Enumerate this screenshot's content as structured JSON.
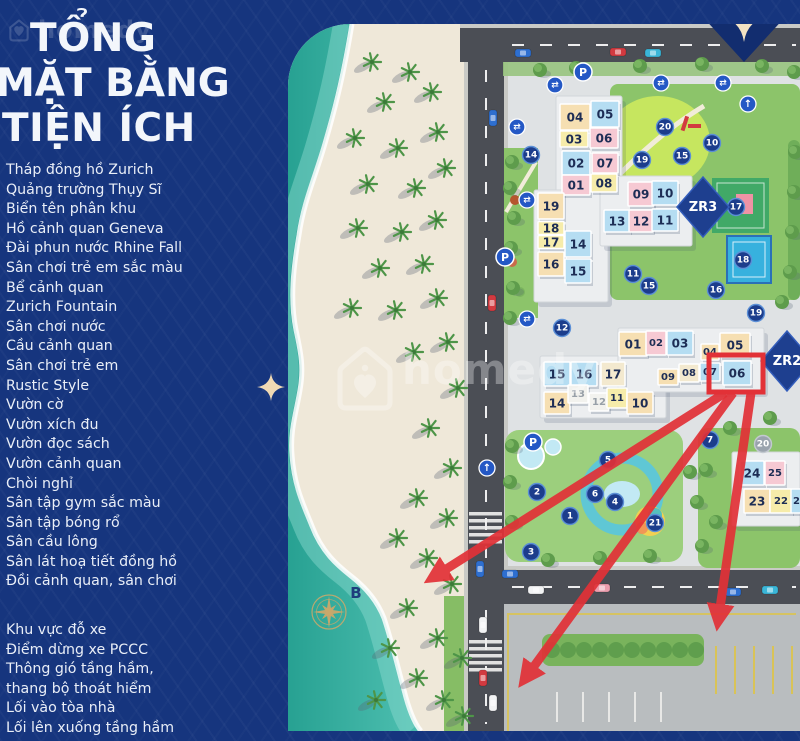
{
  "watermark": {
    "brand": "homedy"
  },
  "panel": {
    "title_lines": [
      "TỔNG",
      "MẶT BẰNG",
      "TIỆN ÍCH"
    ],
    "legend_main": [
      "Tháp đồng hồ Zurich",
      "Quảng trường Thụy Sĩ",
      "Biển tên phân khu",
      "Hồ cảnh quan Geneva",
      "Đài phun nước Rhine Fall",
      "Sân chơi trẻ em sắc màu",
      "Bể cảnh quan",
      "Zurich Fountain",
      "Sân chơi nước",
      "Cầu cảnh quan",
      "Sân chơi trẻ em",
      "Rustic Style",
      "Vườn cờ",
      "Vườn xích đu",
      "Vườn đọc sách",
      "Vườn cảnh quan",
      "Chòi nghỉ",
      "Sân tập gym sắc màu",
      "Sân tập bóng rổ",
      "Sân cầu lông",
      "Sân lát hoạ tiết đồng hồ",
      "Đồi cảnh quan, sân chơi"
    ],
    "legend_secondary": [
      "Khu vực đỗ xe",
      "Điểm dừng xe PCCC",
      "Thông gió tầng hầm,\nthang bộ thoát hiểm",
      "Lối vào tòa nhà",
      "Lối lên xuống tầng hầm"
    ]
  },
  "map": {
    "compass": {
      "label": "B",
      "x": 329,
      "y": 612
    },
    "zones": [
      {
        "label": "ZR3",
        "x": 703,
        "y": 207
      },
      {
        "label": "ZR2",
        "x": 787,
        "y": 361
      }
    ],
    "buildings": [
      {
        "n": "04",
        "x": 575,
        "y": 117,
        "w": 30,
        "h": 26,
        "c": "tan"
      },
      {
        "n": "05",
        "x": 605,
        "y": 114,
        "w": 28,
        "h": 26,
        "c": "blue"
      },
      {
        "n": "03",
        "x": 574,
        "y": 139,
        "w": 28,
        "h": 16,
        "c": "yellow"
      },
      {
        "n": "06",
        "x": 604,
        "y": 138,
        "w": 28,
        "h": 20,
        "c": "pink"
      },
      {
        "n": "02",
        "x": 576,
        "y": 163,
        "w": 28,
        "h": 24,
        "c": "blue"
      },
      {
        "n": "07",
        "x": 605,
        "y": 163,
        "w": 26,
        "h": 20,
        "c": "pink"
      },
      {
        "n": "01",
        "x": 576,
        "y": 185,
        "w": 28,
        "h": 20,
        "c": "pink"
      },
      {
        "n": "08",
        "x": 604,
        "y": 183,
        "w": 26,
        "h": 18,
        "c": "yellow"
      },
      {
        "n": "19",
        "x": 551,
        "y": 206,
        "w": 26,
        "h": 26,
        "c": "tan"
      },
      {
        "n": "18",
        "x": 551,
        "y": 228,
        "w": 26,
        "h": 13,
        "c": "yellow"
      },
      {
        "n": "17",
        "x": 551,
        "y": 242,
        "w": 26,
        "h": 13,
        "c": "yellow"
      },
      {
        "n": "16",
        "x": 551,
        "y": 264,
        "w": 26,
        "h": 24,
        "c": "tan"
      },
      {
        "n": "14",
        "x": 578,
        "y": 244,
        "w": 26,
        "h": 26,
        "c": "blue"
      },
      {
        "n": "15",
        "x": 578,
        "y": 271,
        "w": 26,
        "h": 24,
        "c": "blue"
      },
      {
        "n": "09",
        "x": 641,
        "y": 194,
        "w": 26,
        "h": 24,
        "c": "pink"
      },
      {
        "n": "10",
        "x": 665,
        "y": 193,
        "w": 26,
        "h": 24,
        "c": "blue"
      },
      {
        "n": "13",
        "x": 617,
        "y": 221,
        "w": 26,
        "h": 22,
        "c": "blue"
      },
      {
        "n": "12",
        "x": 641,
        "y": 221,
        "w": 24,
        "h": 22,
        "c": "pink"
      },
      {
        "n": "11",
        "x": 665,
        "y": 220,
        "w": 26,
        "h": 22,
        "c": "blue"
      },
      {
        "n": "01",
        "x": 633,
        "y": 344,
        "w": 28,
        "h": 24,
        "c": "tan"
      },
      {
        "n": "02",
        "x": 656,
        "y": 343,
        "w": 20,
        "h": 24,
        "c": "pink"
      },
      {
        "n": "03",
        "x": 680,
        "y": 343,
        "w": 26,
        "h": 24,
        "c": "blue"
      },
      {
        "n": "04",
        "x": 710,
        "y": 352,
        "w": 18,
        "h": 16,
        "c": "tan"
      },
      {
        "n": "05",
        "x": 735,
        "y": 345,
        "w": 30,
        "h": 24,
        "c": "tan"
      },
      {
        "n": "09",
        "x": 668,
        "y": 377,
        "w": 20,
        "h": 16,
        "c": "tan"
      },
      {
        "n": "08",
        "x": 689,
        "y": 373,
        "w": 20,
        "h": 18,
        "c": "cream"
      },
      {
        "n": "07",
        "x": 710,
        "y": 372,
        "w": 20,
        "h": 18,
        "c": "blue"
      },
      {
        "n": "06",
        "x": 737,
        "y": 373,
        "w": 28,
        "h": 24,
        "c": "blue"
      },
      {
        "n": "15",
        "x": 557,
        "y": 374,
        "w": 26,
        "h": 24,
        "c": "blue"
      },
      {
        "n": "16",
        "x": 584,
        "y": 374,
        "w": 26,
        "h": 24,
        "c": "blue"
      },
      {
        "n": "17",
        "x": 613,
        "y": 374,
        "w": 24,
        "h": 24,
        "c": "cream"
      },
      {
        "n": "14",
        "x": 557,
        "y": 403,
        "w": 26,
        "h": 22,
        "c": "tan"
      },
      {
        "n": "13",
        "x": 578,
        "y": 394,
        "w": 20,
        "h": 18,
        "c": "white",
        "muted": true
      },
      {
        "n": "12",
        "x": 599,
        "y": 402,
        "w": 20,
        "h": 18,
        "c": "white",
        "muted": true
      },
      {
        "n": "11",
        "x": 617,
        "y": 398,
        "w": 20,
        "h": 20,
        "c": "yellow"
      },
      {
        "n": "10",
        "x": 640,
        "y": 403,
        "w": 26,
        "h": 22,
        "c": "tan"
      },
      {
        "n": "24",
        "x": 752,
        "y": 473,
        "w": 24,
        "h": 24,
        "c": "blue"
      },
      {
        "n": "25",
        "x": 775,
        "y": 473,
        "w": 20,
        "h": 24,
        "c": "pink"
      },
      {
        "n": "23",
        "x": 757,
        "y": 501,
        "w": 26,
        "h": 24,
        "c": "tan"
      },
      {
        "n": "22",
        "x": 781,
        "y": 501,
        "w": 22,
        "h": 24,
        "c": "yellow"
      },
      {
        "n": "21",
        "x": 800,
        "y": 501,
        "w": 18,
        "h": 24,
        "c": "blue"
      }
    ],
    "badges": [
      {
        "n": "14",
        "x": 531,
        "y": 155
      },
      {
        "n": "20",
        "x": 665,
        "y": 127
      },
      {
        "n": "10",
        "x": 712,
        "y": 143
      },
      {
        "n": "15",
        "x": 682,
        "y": 156
      },
      {
        "n": "19",
        "x": 642,
        "y": 160
      },
      {
        "n": "17",
        "x": 736,
        "y": 207
      },
      {
        "n": "18",
        "x": 743,
        "y": 260
      },
      {
        "n": "11",
        "x": 633,
        "y": 274
      },
      {
        "n": "15",
        "x": 649,
        "y": 286
      },
      {
        "n": "16",
        "x": 716,
        "y": 290
      },
      {
        "n": "19",
        "x": 756,
        "y": 313
      },
      {
        "n": "12",
        "x": 562,
        "y": 328
      },
      {
        "n": "7",
        "x": 710,
        "y": 440
      },
      {
        "n": "5",
        "x": 608,
        "y": 460
      },
      {
        "n": "2",
        "x": 537,
        "y": 492
      },
      {
        "n": "6",
        "x": 595,
        "y": 494
      },
      {
        "n": "4",
        "x": 615,
        "y": 502
      },
      {
        "n": "1",
        "x": 570,
        "y": 516
      },
      {
        "n": "21",
        "x": 655,
        "y": 523
      },
      {
        "n": "3",
        "x": 531,
        "y": 552
      },
      {
        "n": "20",
        "x": 763,
        "y": 444,
        "grey": true
      }
    ],
    "p_markers": [
      {
        "x": 583,
        "y": 72
      },
      {
        "x": 505,
        "y": 257
      },
      {
        "x": 533,
        "y": 442
      }
    ],
    "swap_markers": [
      {
        "x": 555,
        "y": 85
      },
      {
        "x": 661,
        "y": 83
      },
      {
        "x": 723,
        "y": 83
      },
      {
        "x": 517,
        "y": 127
      },
      {
        "x": 527,
        "y": 200
      },
      {
        "x": 527,
        "y": 319
      }
    ],
    "arrow_markers": [
      {
        "x": 487,
        "y": 468
      },
      {
        "x": 748,
        "y": 104
      }
    ],
    "cars": [
      {
        "x": 523,
        "y": 53,
        "c": "blue",
        "o": "h"
      },
      {
        "x": 618,
        "y": 52,
        "c": "red",
        "o": "h"
      },
      {
        "x": 653,
        "y": 53,
        "c": "teal",
        "o": "h"
      },
      {
        "x": 493,
        "y": 118,
        "c": "blue",
        "o": "v"
      },
      {
        "x": 492,
        "y": 303,
        "c": "red",
        "o": "v"
      },
      {
        "x": 480,
        "y": 569,
        "c": "blue",
        "o": "v"
      },
      {
        "x": 483,
        "y": 625,
        "c": "white",
        "o": "v"
      },
      {
        "x": 483,
        "y": 678,
        "c": "red",
        "o": "v"
      },
      {
        "x": 493,
        "y": 703,
        "c": "white",
        "o": "v"
      },
      {
        "x": 510,
        "y": 574,
        "c": "blue",
        "o": "h"
      },
      {
        "x": 536,
        "y": 590,
        "c": "white",
        "o": "h"
      },
      {
        "x": 602,
        "y": 588,
        "c": "pink",
        "o": "h"
      },
      {
        "x": 733,
        "y": 592,
        "c": "blue",
        "o": "h"
      },
      {
        "x": 770,
        "y": 590,
        "c": "teal",
        "o": "h"
      }
    ],
    "highlight": {
      "box": {
        "x": 709,
        "y": 355,
        "w": 54,
        "h": 37
      },
      "arrows": [
        {
          "x1": 725,
          "y1": 393,
          "x2": 432,
          "y2": 578
        },
        {
          "x1": 733,
          "y1": 393,
          "x2": 524,
          "y2": 680
        },
        {
          "x1": 751,
          "y1": 393,
          "x2": 718,
          "y2": 622
        }
      ]
    }
  },
  "colors": {
    "panel": "#16357e",
    "band": "#122d6f",
    "sea": "#2fae9f",
    "sea_light": "#56c4b4",
    "sand": "#efe8d9",
    "zone_grey": "#dfe2e4",
    "road": "#4b4e55",
    "lawn": "#8cc46a",
    "bright_lawn": "#c6e65f",
    "court_green": "#41a967",
    "court_blue": "#37b1de",
    "court_pink": "#ef93a5",
    "unit_tan": "#f6dfb2",
    "unit_blue": "#b5ddf2",
    "unit_pink": "#f6c9d3",
    "unit_yellow": "#f6ecaa",
    "unit_cream": "#f3e9cf",
    "unit_white": "#f2f2ee",
    "badge": "#1c3d8c",
    "badge_ring": "#5b8fd6",
    "badge_grey": "#9aa3ad",
    "marker_blue": "#2458c5",
    "zone_diamond": "#1e3f8f",
    "red": "#e23137",
    "gold": "#c9a86b",
    "car_blue": "#2e6fd0",
    "car_red": "#d23a40",
    "car_teal": "#3ab6d8",
    "car_white": "#f2f3f4",
    "car_pink": "#eb9eae"
  }
}
